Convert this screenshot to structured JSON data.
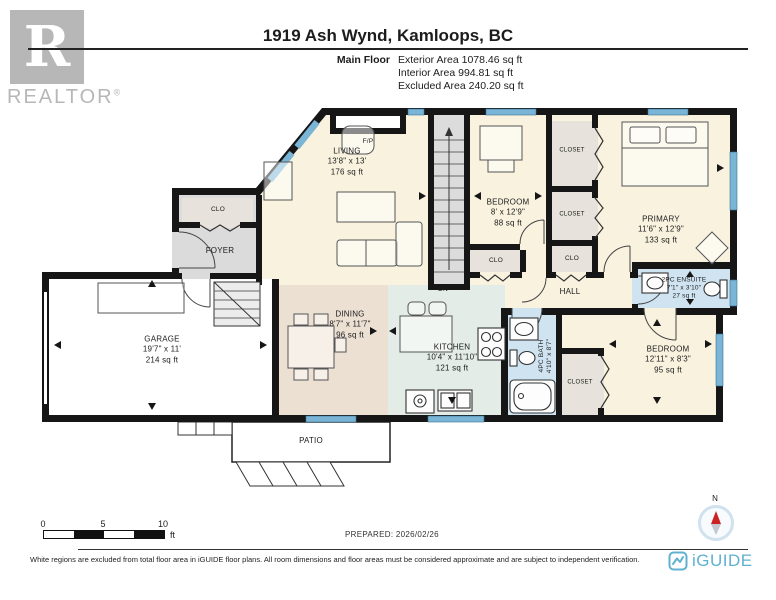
{
  "header": {
    "logo": {
      "letter": "R",
      "text": "REALTOR",
      "reg": "®"
    },
    "title": "1919 Ash Wynd, Kamloops, BC",
    "floor_label": "Main Floor",
    "stats": [
      "Exterior Area 1078.46 sq ft",
      "Interior Area 994.81 sq ft",
      "Excluded Area 240.20 sq ft"
    ]
  },
  "rooms": {
    "living": {
      "name": "LIVING",
      "dims": "13'8\" x 13'",
      "area": "176 sq ft"
    },
    "dining": {
      "name": "DINING",
      "dims": "8'7\" x 11'7\"",
      "area": "96 sq ft"
    },
    "kitchen": {
      "name": "KITCHEN",
      "dims": "10'4\" x 11'10\"",
      "area": "121 sq ft"
    },
    "garage": {
      "name": "GARAGE",
      "dims": "19'7\" x 11'",
      "area": "214 sq ft"
    },
    "bedroom_top": {
      "name": "BEDROOM",
      "dims": "8' x 12'9\"",
      "area": "88 sq ft"
    },
    "primary": {
      "name": "PRIMARY",
      "dims": "11'6\" x 12'9\"",
      "area": "133 sq ft"
    },
    "ensuite": {
      "name": "2PC ENSUITE",
      "dims": "7'1\" x 3'10\"",
      "area": "27 sq ft"
    },
    "bath": {
      "name": "4PC BATH",
      "dims": "4'10\" x 8'7\""
    },
    "bedroom_bottom": {
      "name": "BEDROOM",
      "dims": "12'11\" x 8'3\"",
      "area": "95 sq ft"
    },
    "hall": {
      "name": "HALL"
    },
    "foyer": {
      "name": "FOYER"
    },
    "patio": {
      "name": "PATIO"
    }
  },
  "labels": {
    "clo": "CLO",
    "closet": "CLOSET",
    "fireplace": "F/P",
    "down": "DN"
  },
  "scale_bar": {
    "ticks": [
      "0",
      "5",
      "10"
    ],
    "unit": "ft"
  },
  "prepared": "PREPARED: 2026/02/26",
  "compass": {
    "north": "N"
  },
  "footer": {
    "disclaimer": "White regions are excluded from total floor area in iGUIDE floor plans. All room dimensions and floor areas must be considered approximate and are subject to independent verification.",
    "brand": "iGUIDE"
  },
  "colors": {
    "wall": "#161616",
    "room_cream": "#f8f2df",
    "room_tan": "#ece0d3",
    "room_mint": "#e3ece6",
    "room_blue": "#cfe3f0",
    "room_gray": "#dbdbdb",
    "closet_beige": "#e7e3dc",
    "window": "#7ab5d6",
    "brand_blue": "#5fb0d1"
  }
}
